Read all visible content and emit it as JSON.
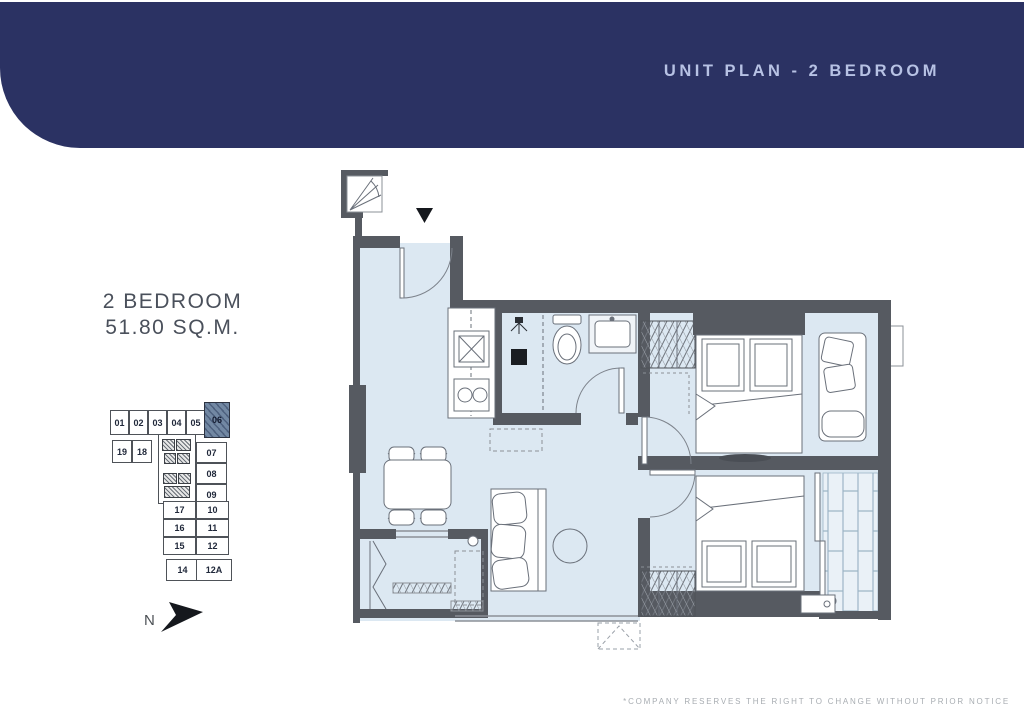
{
  "header": {
    "title": "UNIT PLAN - 2 BEDROOM"
  },
  "unit_info": {
    "type": "2 BEDROOM",
    "area": "51.80 SQ.M."
  },
  "keyplan": {
    "cells": [
      {
        "label": "01",
        "highlighted": false
      },
      {
        "label": "02",
        "highlighted": false
      },
      {
        "label": "03",
        "highlighted": false
      },
      {
        "label": "04",
        "highlighted": false
      },
      {
        "label": "05",
        "highlighted": false
      },
      {
        "label": "06",
        "highlighted": true
      },
      {
        "label": "19",
        "highlighted": false
      },
      {
        "label": "18",
        "highlighted": false
      },
      {
        "label": "07",
        "highlighted": false
      },
      {
        "label": "08",
        "highlighted": false
      },
      {
        "label": "09",
        "highlighted": false
      },
      {
        "label": "17",
        "highlighted": false
      },
      {
        "label": "10",
        "highlighted": false
      },
      {
        "label": "16",
        "highlighted": false
      },
      {
        "label": "11",
        "highlighted": false
      },
      {
        "label": "15",
        "highlighted": false
      },
      {
        "label": "12",
        "highlighted": false
      },
      {
        "label": "14",
        "highlighted": false
      },
      {
        "label": "12A",
        "highlighted": false
      }
    ]
  },
  "north": {
    "label": "N"
  },
  "footer": {
    "disclaimer": "*COMPANY RESERVES THE RIGHT TO CHANGE WITHOUT PRIOR NOTICE"
  },
  "plan": {
    "icons": [
      "entry-arrow-icon",
      "entry-door-icon",
      "ac-ledge-fan-icon",
      "kitchen-sink-icon",
      "stove-icon",
      "shower-icon",
      "toilet-icon",
      "basin-icon",
      "wardrobe-icon",
      "double-bed-icon",
      "bench-seat-icon",
      "sofa-icon",
      "dining-table-icon",
      "round-table-icon",
      "balcony-tile-icon",
      "washer-area-icon",
      "tv-icon",
      "condenser-unit-icon",
      "north-arrow-icon"
    ]
  },
  "colors": {
    "header-bg": "#2b3263",
    "header-text": "#b7c2e4",
    "title-text": "#4a505b",
    "floor": "#dce8f2",
    "wall": "#565a61",
    "hl": "#7288a3",
    "muted": "#a8adb2"
  }
}
